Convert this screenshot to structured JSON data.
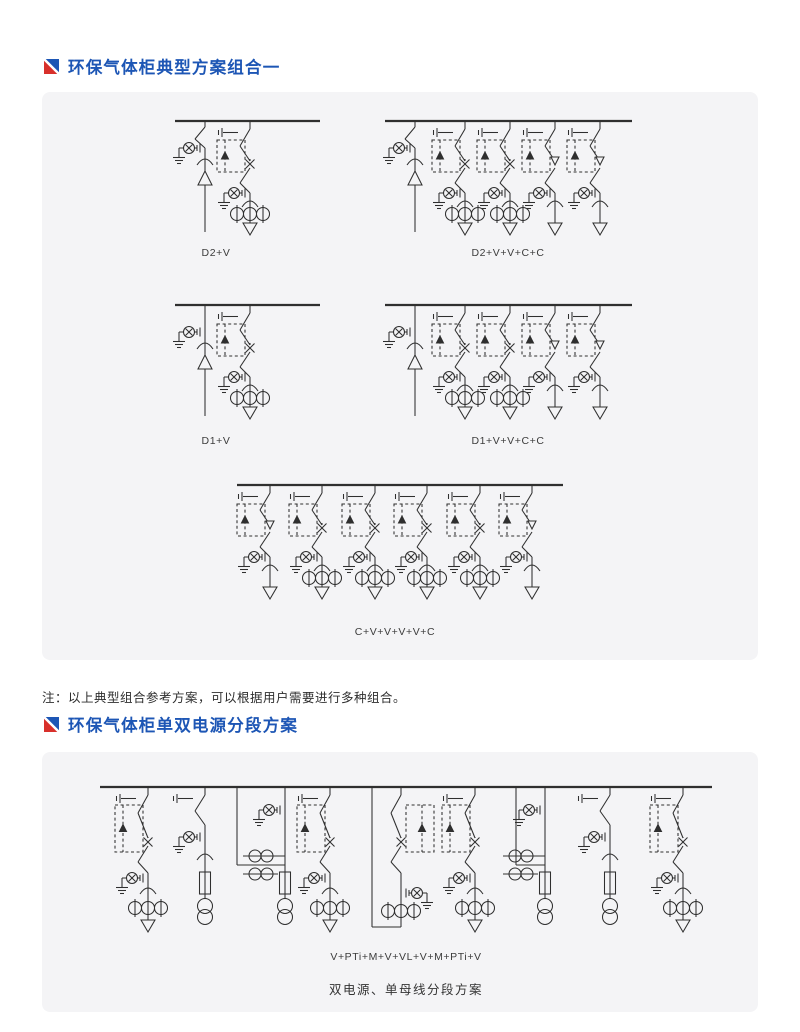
{
  "colors": {
    "title_blue": "#1d56b5",
    "flag_blue": "#1d56b5",
    "flag_red": "#d8302b",
    "line": "#2f2f2f",
    "panel_bg": "#f4f4f6",
    "label_gray": "#3c3c3c"
  },
  "sections": [
    {
      "title": "环保气体柜典型方案组合一"
    },
    {
      "title": "环保气体柜单双电源分段方案"
    }
  ],
  "note": "注：以上典型组合参考方案，可以根据用户需要进行多种组合。",
  "schematics": {
    "panel1": {
      "diagrams": [
        {
          "label": "D2+V",
          "busY": 29,
          "bus": [
            133,
            278
          ],
          "branches": [
            {
              "t": "D2",
              "x": 163
            },
            {
              "t": "V",
              "x": 208
            }
          ],
          "label_x": 174,
          "label_y": 155
        },
        {
          "label": "D2+V+V+C+C",
          "busY": 29,
          "bus": [
            343,
            590
          ],
          "branches": [
            {
              "t": "D2",
              "x": 373
            },
            {
              "t": "V",
              "x": 423
            },
            {
              "t": "V",
              "x": 468
            },
            {
              "t": "C",
              "x": 513
            },
            {
              "t": "C",
              "x": 558
            }
          ],
          "label_x": 466,
          "label_y": 155
        },
        {
          "label": "D1+V",
          "busY": 213,
          "bus": [
            133,
            278
          ],
          "branches": [
            {
              "t": "D1",
              "x": 163
            },
            {
              "t": "V",
              "x": 208
            }
          ],
          "label_x": 174,
          "label_y": 343
        },
        {
          "label": "D1+V+V+C+C",
          "busY": 213,
          "bus": [
            343,
            590
          ],
          "branches": [
            {
              "t": "D1",
              "x": 373
            },
            {
              "t": "V",
              "x": 423
            },
            {
              "t": "V",
              "x": 468
            },
            {
              "t": "C",
              "x": 513
            },
            {
              "t": "C",
              "x": 558
            }
          ],
          "label_x": 466,
          "label_y": 343
        },
        {
          "label": "C+V+V+V+V+C",
          "busY": 393,
          "bus": [
            195,
            521
          ],
          "branches": [
            {
              "t": "C",
              "x": 228
            },
            {
              "t": "V",
              "x": 280
            },
            {
              "t": "V",
              "x": 333
            },
            {
              "t": "V",
              "x": 385
            },
            {
              "t": "V",
              "x": 438
            },
            {
              "t": "C",
              "x": 490
            }
          ],
          "label_x": 353,
          "label_y": 534
        }
      ]
    },
    "panel2": {
      "diagrams": [
        {
          "label": "V+PTi+M+V+VL+V+M+PTi+V",
          "sublabel": "双电源、单母线分段方案",
          "busY": 35,
          "bus": [
            58,
            670
          ],
          "profile": "tall",
          "branches": [
            {
              "t": "V",
              "x": 106
            },
            {
              "t": "PTi",
              "x": 163
            },
            {
              "t": "M",
              "x": 243,
              "drop": 195
            },
            {
              "t": "V",
              "x": 288
            },
            {
              "t": "VL",
              "x": 359,
              "drop": 330
            },
            {
              "t": "V",
              "x": 433
            },
            {
              "t": "M",
              "x": 503,
              "drop": 474
            },
            {
              "t": "PTi",
              "x": 568
            },
            {
              "t": "V",
              "x": 641
            }
          ],
          "label_x": 364,
          "label_y": 199,
          "sublabel_x": 364,
          "sublabel_y": 229
        }
      ]
    }
  }
}
